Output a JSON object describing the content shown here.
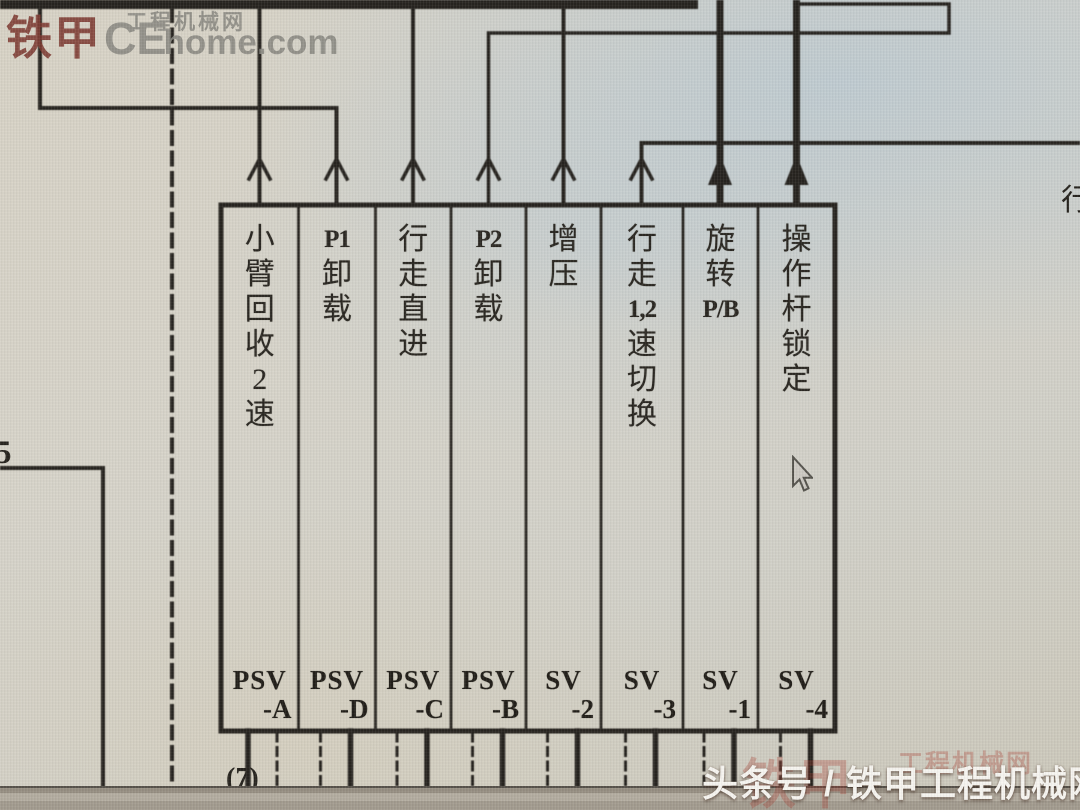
{
  "top_watermark": {
    "brand": "铁甲",
    "site_caps": "CE",
    "site_rest": "home.com",
    "site_cn": "工程机械网"
  },
  "margin_labels": {
    "left_number": "5",
    "bottom_number": "(7)",
    "right_partial": "行"
  },
  "valve_columns": [
    {
      "function": "小臂回收2速",
      "function_units": [
        "小",
        "臂",
        "回",
        "收",
        "2",
        "速"
      ],
      "device": "PSV",
      "suffix": "-A"
    },
    {
      "function": "P1卸载",
      "function_units": [
        "P1",
        "卸",
        "载"
      ],
      "device": "PSV",
      "suffix": "-D"
    },
    {
      "function": "行走直进",
      "function_units": [
        "行",
        "走",
        "直",
        "进"
      ],
      "device": "PSV",
      "suffix": "-C"
    },
    {
      "function": "P2卸载",
      "function_units": [
        "P2",
        "卸",
        "载"
      ],
      "device": "PSV",
      "suffix": "-B"
    },
    {
      "function": "增压",
      "function_units": [
        "增",
        "压"
      ],
      "device": "SV",
      "suffix": "-2"
    },
    {
      "function": "行走1,2速切换",
      "function_units": [
        "行",
        "走",
        "1,2",
        "速",
        "切",
        "换"
      ],
      "device": "SV",
      "suffix": "-3"
    },
    {
      "function": "旋转P/B",
      "function_units": [
        "旋",
        "转",
        "P/B"
      ],
      "device": "SV",
      "suffix": "-1"
    },
    {
      "function": "操作杆锁定",
      "function_units": [
        "操",
        "作",
        "杆",
        "锁",
        "定"
      ],
      "device": "SV",
      "suffix": "-4"
    }
  ],
  "bottom_banner": {
    "text": "头条号 / 铁甲工程机械网",
    "watermark_brand": "铁甲",
    "watermark_site": "工程机械网"
  },
  "colors": {
    "schematic_line": "#26231e",
    "paper_warm": "#d8d3c5",
    "paper_cool": "#ccd4da",
    "brand_red": "#7e3a31",
    "watermark_grey": "#8b8a82",
    "banner_text_white": "#f7f5f0",
    "banner_watermark_red": "#a63428"
  }
}
